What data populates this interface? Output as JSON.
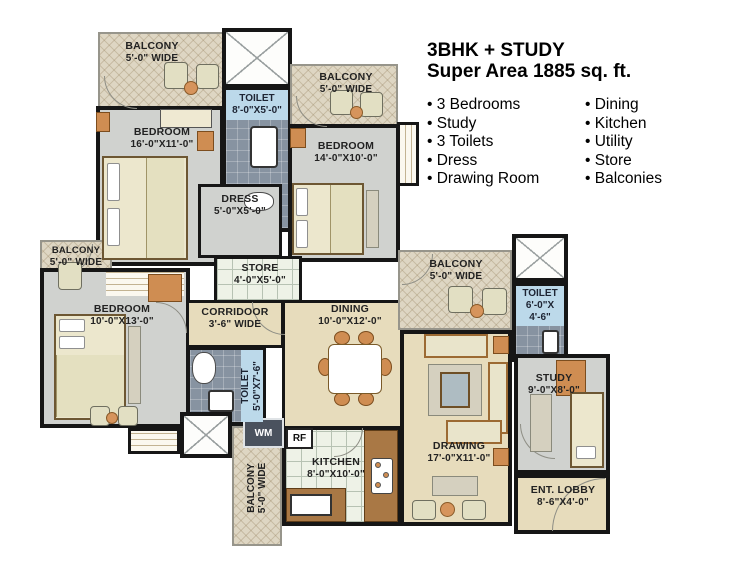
{
  "header": {
    "title": "3BHK + STUDY",
    "subtitle": "Super Area 1885 sq. ft."
  },
  "features": {
    "column1": [
      "3 Bedrooms",
      "Study",
      "3 Toilets",
      "Dress",
      "Drawing Room"
    ],
    "column2": [
      "Dining",
      "Kitchen",
      "Utility",
      "Store",
      "Balconies"
    ]
  },
  "rooms": {
    "balcony_top_left": {
      "name": "BALCONY",
      "dims": "5'-0\" WIDE"
    },
    "toilet_top": {
      "name": "TOILET",
      "dims": "8'-0\"X5'-0\""
    },
    "balcony_top_mid": {
      "name": "BALCONY",
      "dims": "5'-0\" WIDE"
    },
    "bedroom_master": {
      "name": "BEDROOM",
      "dims": "16'-0\"X11'-0\""
    },
    "bedroom_mid": {
      "name": "BEDROOM",
      "dims": "14'-0\"X10'-0\""
    },
    "dress": {
      "name": "DRESS",
      "dims": "5'-0\"X5'-0\""
    },
    "store": {
      "name": "STORE",
      "dims": "4'-0\"X5'-0\""
    },
    "balcony_left": {
      "name": "BALCONY",
      "dims": "5'-0\" WIDE"
    },
    "bedroom_left": {
      "name": "BEDROOM",
      "dims": "10'-0\"X13'-0\""
    },
    "corridor": {
      "name": "CORRIDOOR",
      "dims": "3'-6\" WIDE"
    },
    "toilet_mid": {
      "name": "TOILET",
      "dims": "5'-0\"X7'-6\""
    },
    "dining": {
      "name": "DINING",
      "dims": "10'-0\"X12'-0\""
    },
    "balcony_right": {
      "name": "BALCONY",
      "dims": "5'-0\" WIDE"
    },
    "toilet_right": {
      "name": "TOILET",
      "dims_line1": "6'-0\"X",
      "dims_line2": "4'-6\""
    },
    "study": {
      "name": "STUDY",
      "dims": "9'-0\"X8'-0\""
    },
    "ent_lobby": {
      "name": "ENT. LOBBY",
      "dims": "8'-6\"X4'-0\""
    },
    "drawing": {
      "name": "DRAWING",
      "dims": "17'-0\"X11'-0\""
    },
    "kitchen": {
      "name": "KITCHEN",
      "dims": "8'-0\"X10'-0\""
    },
    "balcony_bottom": {
      "name": "BALCONY",
      "dims": "5'-0\" WIDE"
    }
  },
  "appliances": {
    "wm": "WM",
    "rf": "RF"
  },
  "colors": {
    "wall": "#161616",
    "bedroom_floor": "#d0d2cf",
    "living_floor": "#e7dcbc",
    "balcony_floor": "#ded6c3",
    "kitchen_tile": "#eef2e7",
    "toilet_floor": "#8793a1",
    "toilet_label_bg": "#bcd9ea",
    "furniture_orange": "#d6945c",
    "furniture_cream": "#ece7cd"
  }
}
